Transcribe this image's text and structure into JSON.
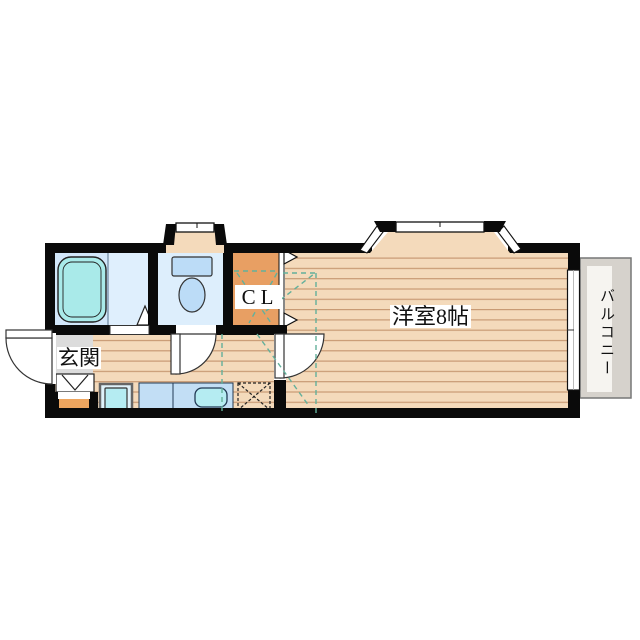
{
  "plan": {
    "type": "apartment-floor-plan",
    "labels": {
      "entrance": "玄関",
      "closet": "CL",
      "main_room": "洋室8帖",
      "balcony": "バルコニー"
    },
    "rooms": [
      {
        "name": "bathroom-with-tub"
      },
      {
        "name": "toilet-room"
      },
      {
        "name": "closet-CL"
      },
      {
        "name": "entrance-genkan"
      },
      {
        "name": "kitchen-hall"
      },
      {
        "name": "western-room-8jo"
      },
      {
        "name": "balcony"
      }
    ],
    "fixtures": [
      "bathtub",
      "toilet",
      "kitchen-counter",
      "kitchen-sink",
      "washing-machine-pan",
      "refrigerator-space",
      "entrance-step",
      "bay-window",
      "toilet-bay-window",
      "sliding-window",
      "hinged-doors",
      "bifold-closet-doors"
    ],
    "colors": {
      "wall": "#0a0a0a",
      "wood_floor": "#f4dabb",
      "wood_stripe": "#c89a74",
      "bathroom_floor": "#d2e7fa",
      "washroom_floor": "#dfeffd",
      "bathtub": "#a9eae9",
      "toilet_floor": "#ddeefc",
      "fixture_blue": "#bcdcf7",
      "closet_orange": "#e89f63",
      "entrance_gray": "#dcdcdc",
      "porch_orange": "#eda55f",
      "counter_blue": "#c2def5",
      "sink_cyan": "#b5ecf2",
      "balcony_gray": "#d6d2cc",
      "balcony_strip": "#f6f4f0",
      "guide_dashed_teal": "#63b09b"
    }
  }
}
